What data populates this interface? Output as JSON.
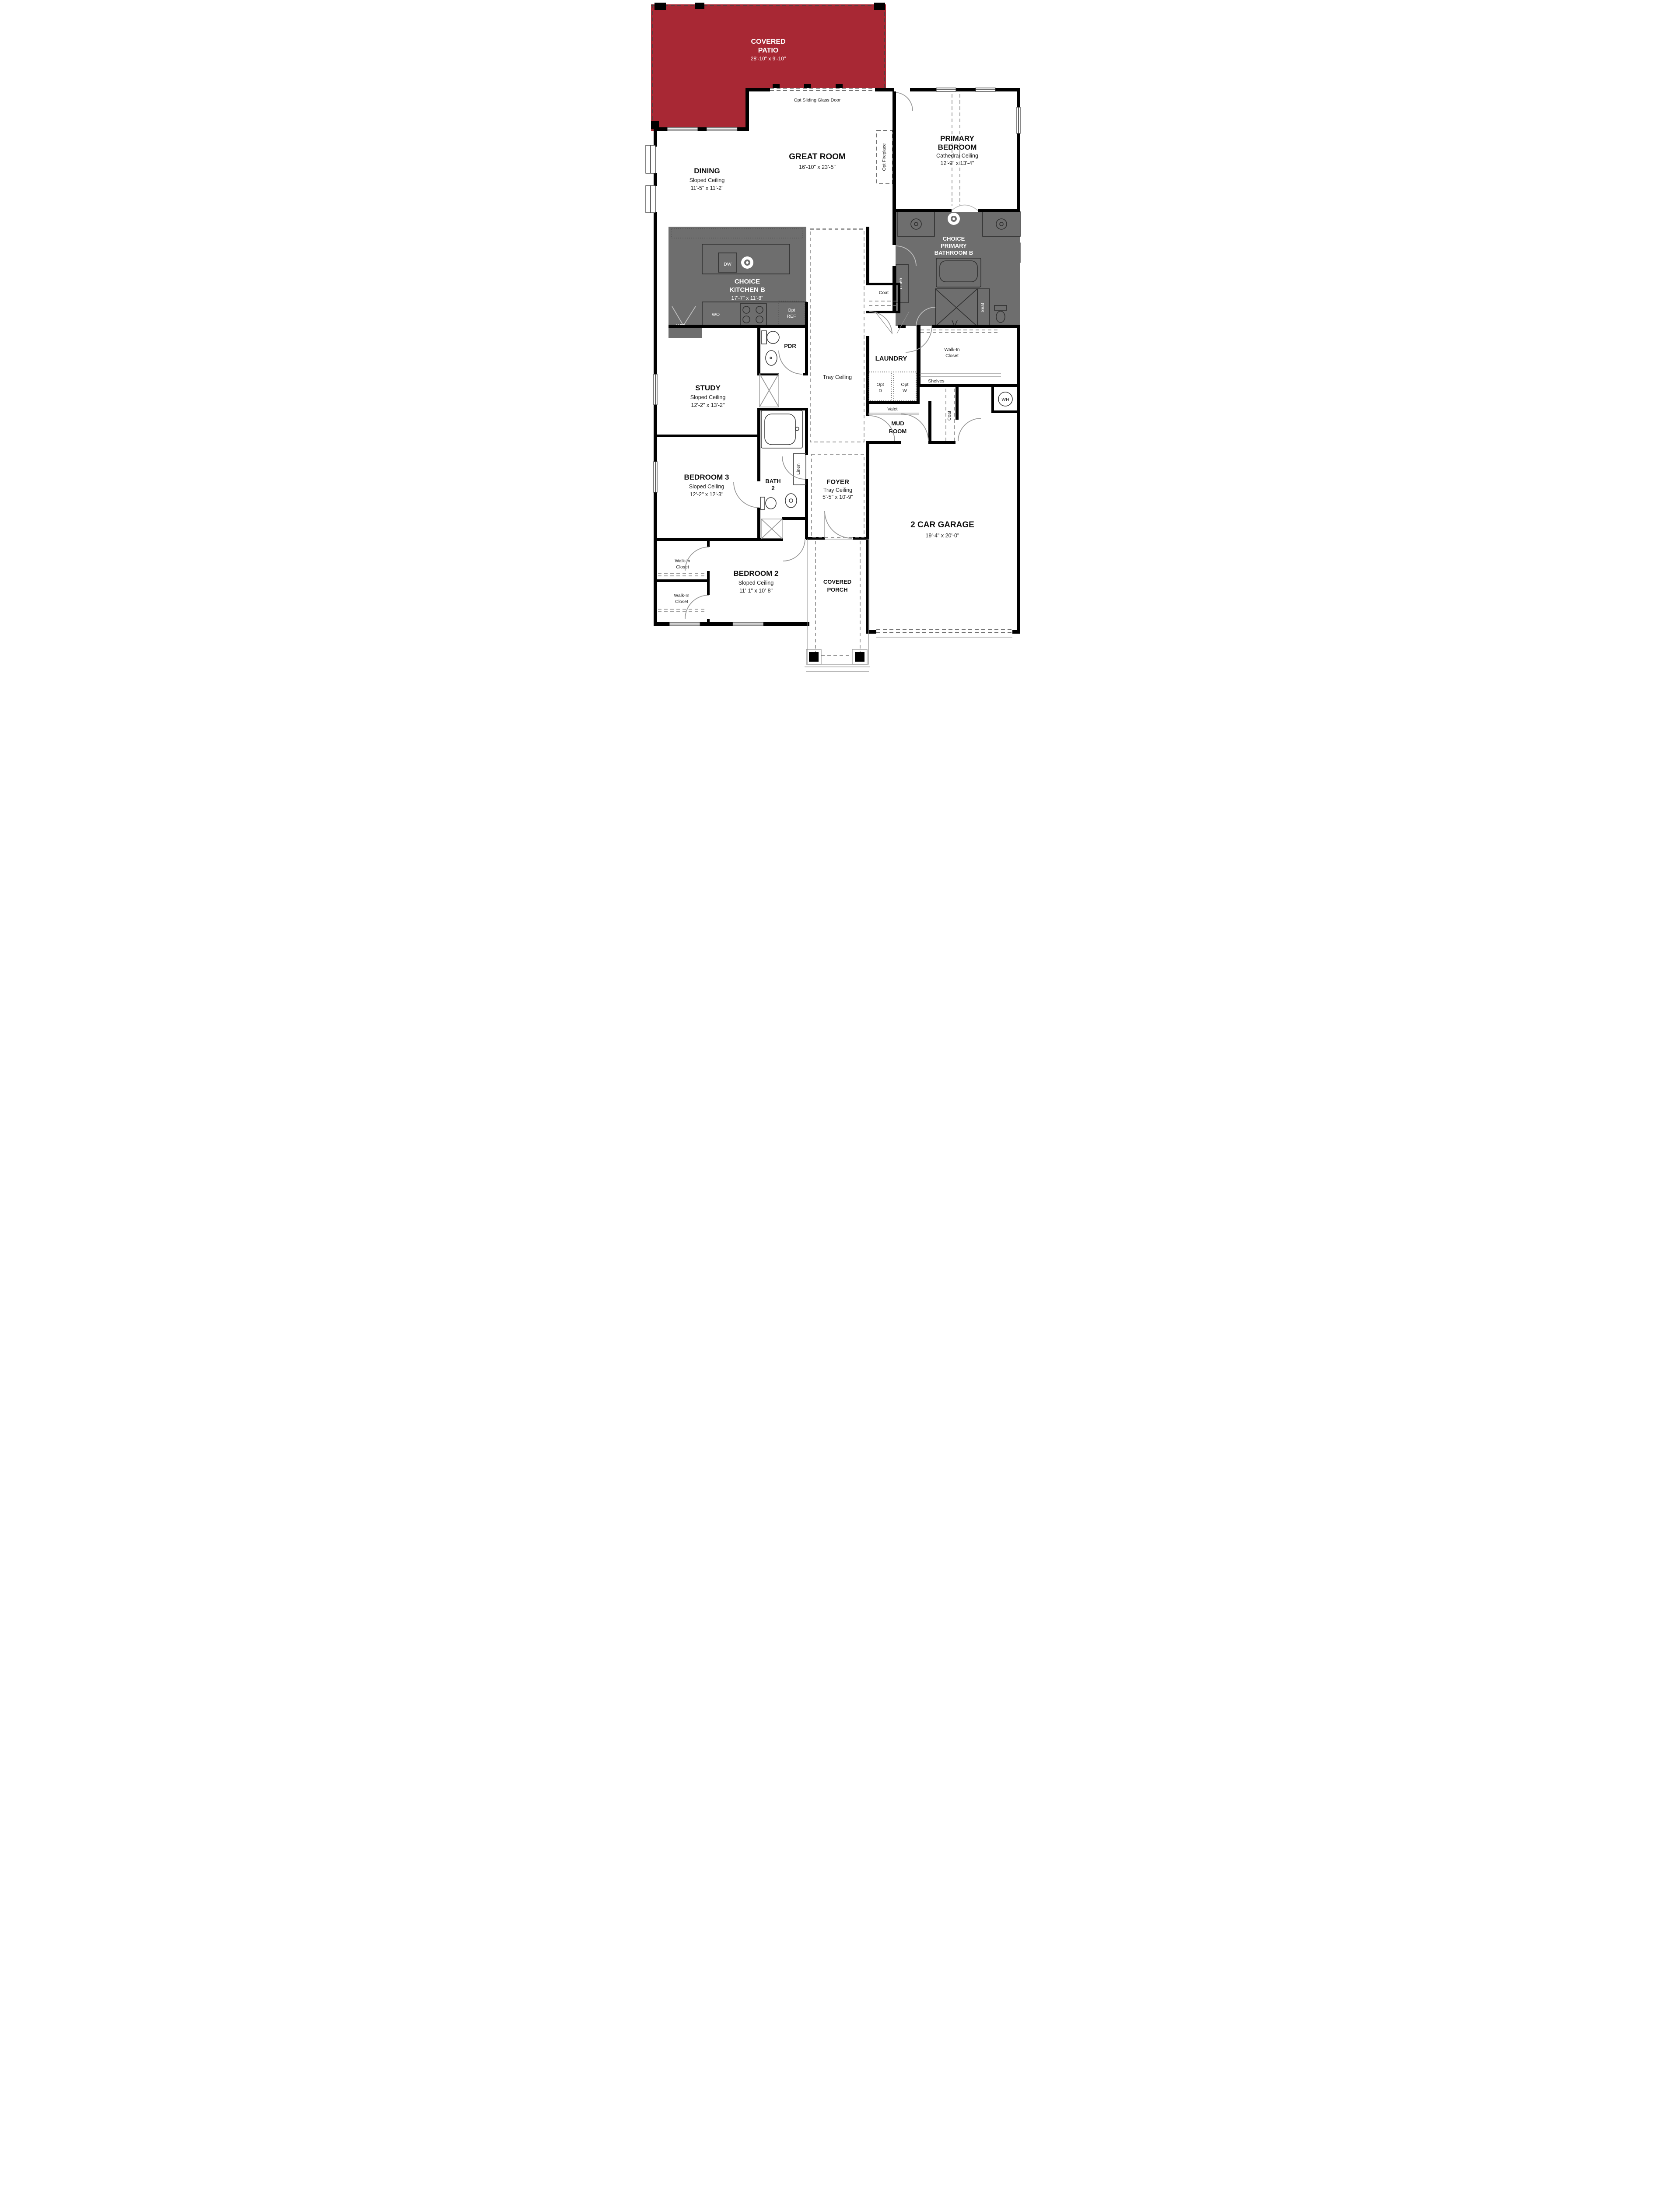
{
  "colors": {
    "patio_red": "#a82834",
    "option_gray": "#6e6e6e",
    "wall_black": "#000000"
  },
  "rooms": {
    "covered_patio": {
      "name1": "COVERED",
      "name2": "PATIO",
      "dims": "28'-10\" x 9'-10\""
    },
    "great_room": {
      "name1": "GREAT ROOM",
      "dims": "16'-10\" x 23'-5\""
    },
    "primary_bedroom": {
      "name1": "PRIMARY",
      "name2": "BEDROOM",
      "ceiling": "Cathedral Ceiling",
      "dims": "12'-9\" x 13'-4\""
    },
    "dining": {
      "name1": "DINING",
      "ceiling": "Sloped Ceiling",
      "dims": "11'-5\" x 11'-2\""
    },
    "choice_kitchen_b": {
      "name1": "CHOICE",
      "name2": "KITCHEN B",
      "dims": "17'-7\" x 11'-8\""
    },
    "choice_primary_bathroom_b": {
      "name1": "CHOICE",
      "name2": "PRIMARY",
      "name3": "BATHROOM B"
    },
    "study": {
      "name1": "STUDY",
      "ceiling": "Sloped Ceiling",
      "dims": "12'-2\" x 13'-2\""
    },
    "pdr": {
      "name1": "PDR"
    },
    "laundry": {
      "name1": "LAUNDRY"
    },
    "mud_room": {
      "name1": "MUD",
      "name2": "ROOM"
    },
    "primary_closet": {
      "name1": "Walk-In",
      "name2": "Closet"
    },
    "foyer": {
      "name1": "FOYER",
      "ceiling": "Tray Ceiling",
      "dims": "5'-5\" x 10'-9\""
    },
    "bath_2": {
      "name1": "BATH",
      "name2": "2"
    },
    "bedroom_3": {
      "name1": "BEDROOM 3",
      "ceiling": "Sloped Ceiling",
      "dims": "12'-2\" x 12'-3\""
    },
    "bedroom_2": {
      "name1": "BEDROOM 2",
      "ceiling": "Sloped Ceiling",
      "dims": "11'-1\" x 10'-8\""
    },
    "garage": {
      "name1": "2 CAR GARAGE",
      "dims": "19'-4\" x 20'-0\""
    },
    "covered_porch": {
      "name1": "COVERED",
      "name2": "PORCH"
    },
    "walk_in_closet_a": {
      "name1": "Walk-In",
      "name2": "Closet"
    },
    "walk_in_closet_b": {
      "name1": "Walk-In",
      "name2": "Closet"
    }
  },
  "annotations": {
    "opt_sliding_glass_door": "Opt Sliding Glass Door",
    "opt_fireplace": "Opt Fireplace",
    "tray_ceiling": "Tray Ceiling",
    "dw": "DW",
    "wo": "WO",
    "wip": "WIP",
    "opt_ref1": "Opt",
    "opt_ref2": "REF",
    "coat": "Coat",
    "coat_garage": "Coat",
    "linen_bath": "Linen",
    "linen_bath2": "Linen",
    "seat": "Seat",
    "shelves": "Shelves",
    "opt_d1": "Opt",
    "opt_d2": "D",
    "opt_w1": "Opt",
    "opt_w2": "W",
    "valet": "Valet",
    "wh": "WH"
  }
}
